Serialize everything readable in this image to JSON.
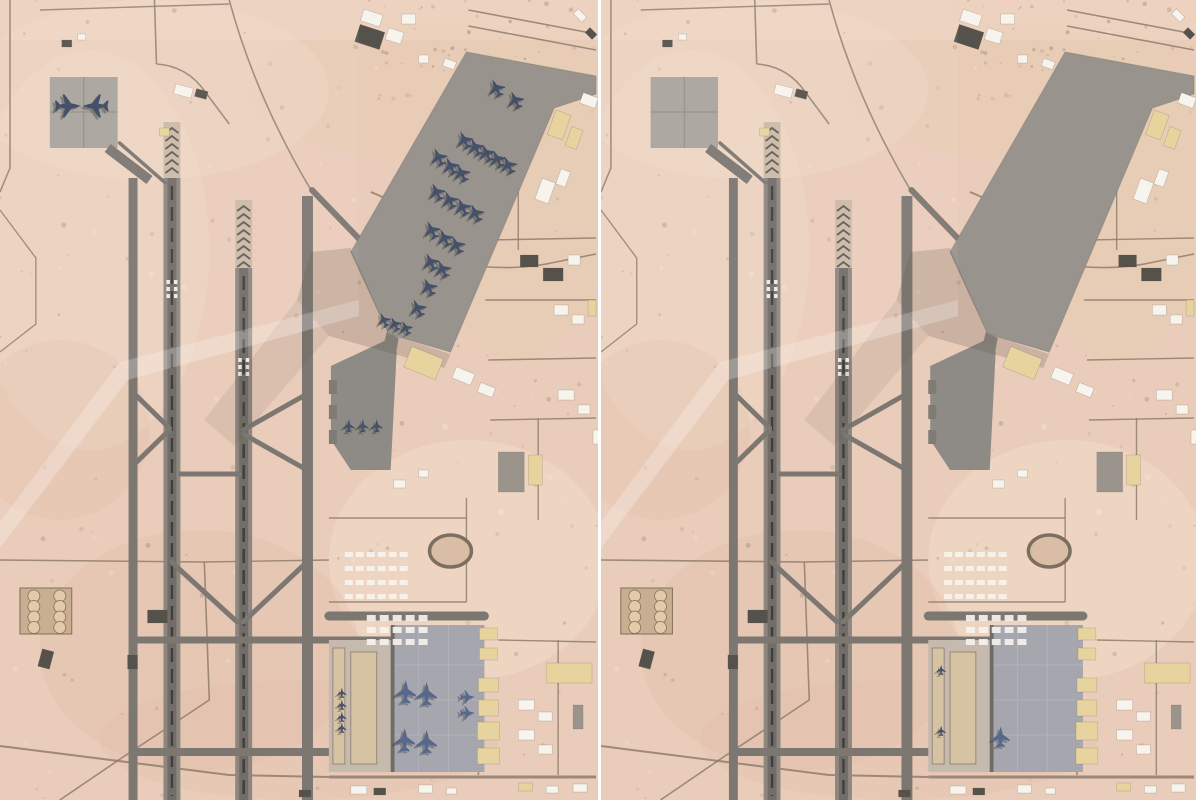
{
  "comparison": {
    "panel_count": 2,
    "left_aircraft_count": 39,
    "right_aircraft_count": 3
  },
  "colors": {
    "desert": "#eaccba",
    "desert_light": "#f2ddc9",
    "desert_dark": "#ddb8a2",
    "desert_tan": "#e6cdb2",
    "road": "#8f7d6d",
    "taxiway": "#7c7771",
    "runway": "#8d8780",
    "runway_core": "#6b6761",
    "centerline": "#403e3a",
    "threshold_pad": "#cdbaa8",
    "chevron": "#5f5b55",
    "apron": "#98938c",
    "apron_mid": "#8e8a85",
    "apron_south": "#a6a7ae",
    "pad_nw": "#a9a49c",
    "pad_south_west": "#c6b9ae",
    "strip_tan": "#d6c3a4",
    "building_white": "#f7f4ee",
    "building_tan": "#e6d39e",
    "building_dark": "#55514b",
    "building_gray": "#9b948c",
    "plane_dark": "#45506a",
    "plane_blue": "#56688e",
    "plane_shadow": "#3a372f",
    "shadow": "#5c5248",
    "seam": "#ffffff",
    "track_ring": "#7c6f60",
    "track_infield": "#d9bda4",
    "fuel_pad": "#c9ae92",
    "fuel_tank": "#e3caa8",
    "fuel_rim": "#80705c",
    "speckle_dark": "#6e5643",
    "speckle_light": "#ffffff"
  },
  "base": {
    "strips": [
      {
        "x": 129,
        "w": 9,
        "y1": 178,
        "y2": 800,
        "f": "taxiway"
      },
      {
        "x": 303,
        "w": 11,
        "y1": 196,
        "y2": 800,
        "f": "taxiway"
      },
      {
        "x": 164,
        "w": 17,
        "y1": 178,
        "y2": 800,
        "f": "runway",
        "center": 172.5,
        "cl_y1": 186,
        "cl_y2": 796,
        "keys_y": 280
      },
      {
        "x": 236,
        "w": 17,
        "y1": 268,
        "y2": 800,
        "f": "runway",
        "center": 244.5,
        "cl_y1": 276,
        "cl_y2": 796,
        "keys_y": 358
      }
    ],
    "threshold_pads": [
      {
        "x": 164,
        "w": 17,
        "y1": 122,
        "y2": 178,
        "chev_y1": 128,
        "chev_y2": 172
      },
      {
        "x": 236,
        "w": 17,
        "y1": 200,
        "y2": 268,
        "chev_y1": 206,
        "chev_y2": 262
      }
    ],
    "stub": {
      "x": 168,
      "w": 8,
      "y1": 150,
      "y2": 180
    },
    "links": [
      [
        313,
        190,
        404,
        284,
        6
      ],
      [
        120,
        143,
        166,
        183,
        3.5
      ],
      [
        133,
        392,
        170,
        428,
        5
      ],
      [
        133,
        466,
        170,
        430,
        5
      ],
      [
        244,
        430,
        308,
        394,
        5
      ],
      [
        244,
        434,
        308,
        470,
        5
      ],
      [
        181,
        474,
        240,
        474,
        5
      ],
      [
        172,
        562,
        238,
        622,
        5
      ],
      [
        308,
        562,
        244,
        622,
        5
      ],
      [
        133,
        640,
        396,
        640,
        7
      ],
      [
        133,
        752,
        396,
        752,
        8
      ],
      [
        330,
        616,
        486,
        616,
        9
      ]
    ],
    "aprons": {
      "main": [
        [
          468,
          52
        ],
        [
          598,
          76
        ],
        [
          598,
          94
        ],
        [
          556,
          108
        ],
        [
          452,
          352
        ],
        [
          390,
          334
        ],
        [
          352,
          252
        ]
      ],
      "main_connector": [
        [
          388,
          332
        ],
        [
          400,
          338
        ],
        [
          394,
          372
        ],
        [
          380,
          366
        ]
      ],
      "mid": [
        [
          332,
          366
        ],
        [
          392,
          338
        ],
        [
          398,
          352
        ],
        [
          392,
          470
        ],
        [
          352,
          470
        ],
        [
          332,
          440
        ]
      ],
      "nw_pad": {
        "x": 50,
        "y": 77,
        "w": 68,
        "h": 71
      },
      "south": {
        "x": 396,
        "y": 625,
        "w": 90,
        "h": 147
      },
      "south_border": {
        "x": 392,
        "y": 625,
        "w": 4,
        "h": 147
      },
      "south_west_pad": {
        "x": 330,
        "y": 640,
        "w": 66,
        "h": 132
      },
      "south_west_strips": [
        [
          334,
          648,
          12,
          116
        ],
        [
          352,
          652,
          26,
          112
        ]
      ]
    },
    "shadows": [
      {
        "pts": [
          [
            352,
            248
          ],
          [
            390,
            334
          ],
          [
            452,
            354
          ],
          [
            446,
            368
          ],
          [
            330,
            336
          ],
          [
            298,
            300
          ],
          [
            312,
            252
          ]
        ],
        "op": 0.22
      },
      {
        "pts": [
          [
            330,
            336
          ],
          [
            298,
            300
          ],
          [
            205,
            420
          ],
          [
            235,
            446
          ]
        ],
        "op": 0.1
      }
    ],
    "haze": [
      {
        "pts": [
          [
            0,
            548
          ],
          [
            128,
            380
          ],
          [
            360,
            316
          ],
          [
            360,
            300
          ],
          [
            120,
            362
          ],
          [
            0,
            522
          ]
        ],
        "c": "#ffffff",
        "op": 0.25
      },
      {
        "pts": [
          [
            0,
            522
          ],
          [
            120,
            362
          ],
          [
            360,
            300
          ],
          [
            360,
            0
          ],
          [
            0,
            0
          ]
        ],
        "c": "#ffffff",
        "op": 0.05
      }
    ],
    "roads": [
      [
        "M10,0 L10,168 L0,192",
        1.6
      ],
      [
        "M155,0 L157,64",
        1.6
      ],
      [
        "M157,64 Q188,66 206,92 L230,124",
        1.6
      ],
      [
        "M230,0 Q256,96 312,190",
        1.6
      ],
      [
        "M470,26 L598,50",
        1.6
      ],
      [
        "M470,10 L598,34",
        1.6
      ],
      [
        "M40,10 L230,4",
        1.4
      ],
      [
        "M372,192 Q438,218 450,262 Q458,306 452,348",
        1.8
      ],
      [
        "M450,262 Q505,272 548,264 L598,254",
        1.6
      ],
      [
        "M0,210 L36,258 L36,324 L0,352",
        1.4
      ],
      [
        "M0,560 L205,562 L210,700 L122,758 L60,800",
        1.6
      ],
      [
        "M205,562 L330,560",
        1.4
      ],
      [
        "M330,518 L468,518",
        1.4
      ],
      [
        "M468,498 L468,602",
        1.4
      ],
      [
        "M330,602 L468,602",
        1.4
      ],
      [
        "M520,150 L520,250",
        1.4
      ],
      [
        "M490,240 L598,238",
        1.4
      ],
      [
        "M487,300 L598,300",
        1.4
      ],
      [
        "M490,360 L598,358",
        1.4
      ],
      [
        "M492,420 L598,418",
        1.4
      ],
      [
        "M540,418 L540,520",
        1.4
      ],
      [
        "M480,640 L480,775",
        1.6
      ],
      [
        "M500,640 L598,642",
        1.4
      ],
      [
        "M560,640 L560,775",
        1.4
      ],
      [
        "M330,777 L598,777",
        3
      ],
      [
        "M0,746 L230,775 L330,777",
        2
      ]
    ],
    "buildings": [
      [
        358,
        28,
        26,
        18,
        18,
        "dark"
      ],
      [
        363,
        12,
        20,
        12,
        18,
        "white"
      ],
      [
        388,
        30,
        16,
        12,
        18,
        "white"
      ],
      [
        403,
        14,
        14,
        10,
        0,
        "white"
      ],
      [
        420,
        55,
        10,
        8,
        0,
        "white"
      ],
      [
        445,
        60,
        12,
        8,
        20,
        "white"
      ],
      [
        583,
        95,
        16,
        11,
        20,
        "white"
      ],
      [
        553,
        112,
        16,
        26,
        20,
        "tan"
      ],
      [
        570,
        128,
        12,
        20,
        20,
        "tan"
      ],
      [
        576,
        12,
        12,
        7,
        45,
        "white"
      ],
      [
        588,
        30,
        10,
        7,
        45,
        "dark"
      ],
      [
        175,
        86,
        18,
        10,
        15,
        "white"
      ],
      [
        196,
        90,
        12,
        8,
        15,
        "dark"
      ],
      [
        160,
        128,
        10,
        8,
        0,
        "tan"
      ],
      [
        540,
        180,
        14,
        22,
        20,
        "white"
      ],
      [
        560,
        170,
        10,
        16,
        20,
        "white"
      ],
      [
        522,
        255,
        18,
        12,
        0,
        "dark"
      ],
      [
        545,
        268,
        20,
        13,
        0,
        "dark"
      ],
      [
        570,
        255,
        12,
        10,
        0,
        "white"
      ],
      [
        556,
        305,
        14,
        10,
        0,
        "white"
      ],
      [
        574,
        315,
        12,
        9,
        0,
        "white"
      ],
      [
        590,
        300,
        8,
        16,
        0,
        "tan"
      ],
      [
        408,
        352,
        34,
        22,
        22,
        "tan"
      ],
      [
        455,
        370,
        20,
        12,
        22,
        "white"
      ],
      [
        480,
        385,
        16,
        10,
        22,
        "white"
      ],
      [
        500,
        452,
        26,
        40,
        0,
        "gray"
      ],
      [
        530,
        455,
        14,
        30,
        0,
        "tan"
      ],
      [
        560,
        390,
        16,
        10,
        0,
        "white"
      ],
      [
        580,
        405,
        12,
        9,
        0,
        "white"
      ],
      [
        595,
        430,
        8,
        14,
        0,
        "white"
      ],
      [
        395,
        480,
        12,
        8,
        0,
        "white"
      ],
      [
        420,
        470,
        10,
        7,
        0,
        "white"
      ],
      [
        548,
        663,
        46,
        20,
        0,
        "tan"
      ],
      [
        520,
        700,
        16,
        10,
        0,
        "white"
      ],
      [
        540,
        712,
        14,
        9,
        0,
        "white"
      ],
      [
        520,
        730,
        16,
        10,
        0,
        "white"
      ],
      [
        540,
        745,
        14,
        9,
        0,
        "white"
      ],
      [
        575,
        705,
        10,
        24,
        0,
        "gray"
      ],
      [
        481,
        628,
        18,
        12,
        0,
        "tan"
      ],
      [
        481,
        648,
        18,
        12,
        0,
        "tan"
      ],
      [
        480,
        678,
        20,
        14,
        0,
        "tan"
      ],
      [
        480,
        700,
        20,
        16,
        0,
        "tan"
      ],
      [
        479,
        722,
        22,
        18,
        0,
        "tan"
      ],
      [
        479,
        748,
        22,
        16,
        0,
        "tan"
      ],
      [
        352,
        786,
        16,
        8,
        0,
        "white"
      ],
      [
        375,
        788,
        12,
        7,
        0,
        "dark"
      ],
      [
        420,
        785,
        14,
        8,
        0,
        "white"
      ],
      [
        448,
        788,
        10,
        6,
        0,
        "white"
      ],
      [
        520,
        783,
        14,
        8,
        0,
        "tan"
      ],
      [
        548,
        786,
        12,
        7,
        0,
        "white"
      ],
      [
        575,
        784,
        14,
        8,
        0,
        "white"
      ],
      [
        300,
        790,
        12,
        7,
        0,
        "dark"
      ],
      [
        148,
        610,
        20,
        13,
        0,
        "dark"
      ],
      [
        40,
        650,
        12,
        18,
        15,
        "dark"
      ],
      [
        128,
        655,
        10,
        14,
        0,
        "dark"
      ],
      [
        62,
        40,
        10,
        7,
        0,
        "dark"
      ],
      [
        78,
        34,
        8,
        6,
        0,
        "white"
      ]
    ],
    "tent_blocks": [
      {
        "x": 346,
        "y": 552,
        "cols": 6,
        "rows": 4,
        "dx": 11,
        "dy": 14,
        "w": 8,
        "h": 5
      },
      {
        "x": 368,
        "y": 615,
        "cols": 5,
        "rows": 3,
        "dx": 13,
        "dy": 12,
        "w": 9,
        "h": 6
      }
    ],
    "track": {
      "cx": 452,
      "cy": 551,
      "rx": 21,
      "ry": 16
    },
    "fuel_farm": {
      "x": 20,
      "y": 588,
      "w": 52,
      "h": 46,
      "tank_r": 6
    }
  },
  "panels": [
    {
      "id": "left",
      "planes": {
        "nw_pad": [
          [
            68,
            106,
            90,
            1.4
          ],
          [
            96,
            106,
            -90,
            1.4
          ]
        ],
        "main_apron": [
          [
            498,
            88,
            -25,
            1
          ],
          [
            517,
            100,
            -25,
            1
          ],
          [
            466,
            140,
            -25,
            1
          ],
          [
            477,
            147,
            -25,
            1
          ],
          [
            488,
            153,
            -25,
            1
          ],
          [
            499,
            159,
            -25,
            1
          ],
          [
            510,
            165,
            -25,
            1
          ],
          [
            440,
            157,
            -25,
            1
          ],
          [
            452,
            166,
            -25,
            1
          ],
          [
            463,
            173,
            -25,
            1
          ],
          [
            438,
            192,
            -25,
            1
          ],
          [
            451,
            200,
            -25,
            1
          ],
          [
            464,
            207,
            -25,
            1
          ],
          [
            477,
            213,
            -25,
            1
          ],
          [
            433,
            230,
            -25,
            1
          ],
          [
            446,
            238,
            -25,
            1
          ],
          [
            458,
            245,
            -25,
            1
          ],
          [
            432,
            262,
            -25,
            1
          ],
          [
            444,
            269,
            -25,
            1
          ],
          [
            430,
            287,
            -25,
            1
          ],
          [
            419,
            308,
            -25,
            1
          ],
          [
            385,
            320,
            -25,
            0.8
          ],
          [
            396,
            324,
            -25,
            0.8
          ],
          [
            407,
            328,
            -25,
            0.8
          ]
        ],
        "mid_apron": [
          [
            350,
            426,
            0,
            0.7
          ],
          [
            364,
            426,
            0,
            0.7
          ],
          [
            378,
            426,
            0,
            0.7
          ]
        ],
        "south_apron": [
          [
            407,
            692,
            0,
            1.25
          ],
          [
            428,
            694,
            0,
            1.25
          ],
          [
            406,
            740,
            0,
            1.25
          ],
          [
            428,
            742,
            0,
            1.25
          ],
          [
            469,
            697,
            90,
            0.8
          ],
          [
            469,
            713,
            90,
            0.8
          ]
        ],
        "west_strip": [
          [
            343,
            693,
            0,
            0.55
          ],
          [
            343,
            705,
            0,
            0.55
          ],
          [
            343,
            717,
            0,
            0.55
          ],
          [
            343,
            728,
            0,
            0.55
          ]
        ]
      }
    },
    {
      "id": "right",
      "planes": {
        "nw_pad": [],
        "main_apron": [],
        "mid_apron": [],
        "south_apron": [
          [
            403,
            737,
            0,
            1.1
          ]
        ],
        "west_strip": [
          [
            343,
            670,
            0,
            0.55
          ],
          [
            343,
            731,
            0,
            0.55
          ]
        ]
      }
    }
  ]
}
